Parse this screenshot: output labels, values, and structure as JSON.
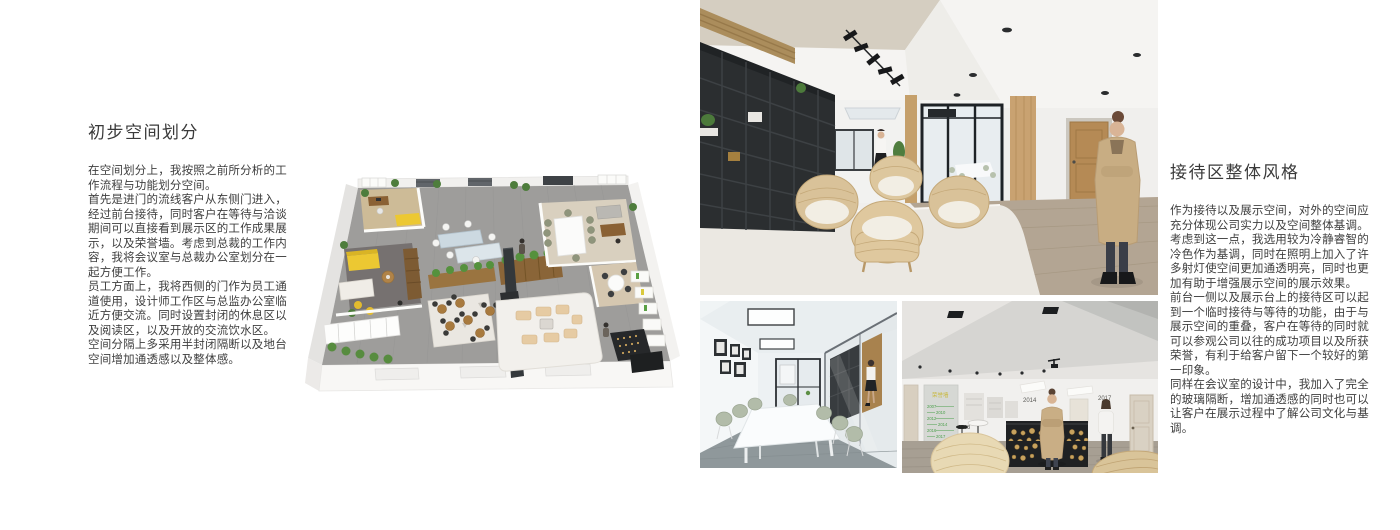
{
  "left_article": {
    "title": "初步空间划分",
    "paragraphs": {
      "p1": "在空间划分上，我按照之前所分析的工作流程与功能划分空间。",
      "p2": "首先是进门的流线客户从东侧门进入，经过前台接待，同时客户在等待与洽谈期间可以直接看到展示区的工作成果展示，以及荣誉墙。考虑到总裁的工作内容，我将会议室与总裁办公室划分在一起方便工作。",
      "p3": "员工方面上，我将西侧的门作为员工通道使用，设计师工作区与总监办公室临近方便交流。同时设置封闭的休息区以及阅读区，以及开放的交流饮水区。",
      "p4": "空间分隔上多采用半封闭隔断以及地台空间增加通透感以及整体感。"
    }
  },
  "right_article": {
    "title": "接待区整体风格",
    "paragraphs": {
      "p1": "作为接待以及展示空间，对外的空间应充分体现公司实力以及空间整体基调。",
      "p2": "考虑到这一点，我选用较为冷静睿智的冷色作为基调，同时在照明上加入了许多射灯使空间更加通透明亮，同时也更加有助于增强展示空间的展示效果。",
      "p3": "前台一侧以及展示台上的接待区可以起到一个临时接待与等待的功能，由于与展示空间的重叠，客户在等待的同时就可以参观公司以往的成功项目以及所获荣誉，有利于给客户留下一个较好的第一印象。",
      "p4": "同样在会议室的设计中，我加入了完全的玻璃隔断，增加通透感的同时也可以让客户在展示过程中了解公司文化与基调。"
    }
  },
  "figures": {
    "reception_desk_photo": {
      "timeline_title": "荣誉墙",
      "timeline_years": [
        "2007",
        "2010",
        "2012",
        "2014",
        "2016",
        "2017"
      ],
      "wall_label_left": "2014",
      "wall_label_right": "2017",
      "floor_label": "2003"
    }
  },
  "colors": {
    "background": "#ffffff",
    "text_primary": "#3e3e3e",
    "sofa_yellow": "#ecc832",
    "plant_green": "#4e7d3c",
    "timeline_green": "#4da04d",
    "timeline_yellow": "#c9b93e"
  }
}
